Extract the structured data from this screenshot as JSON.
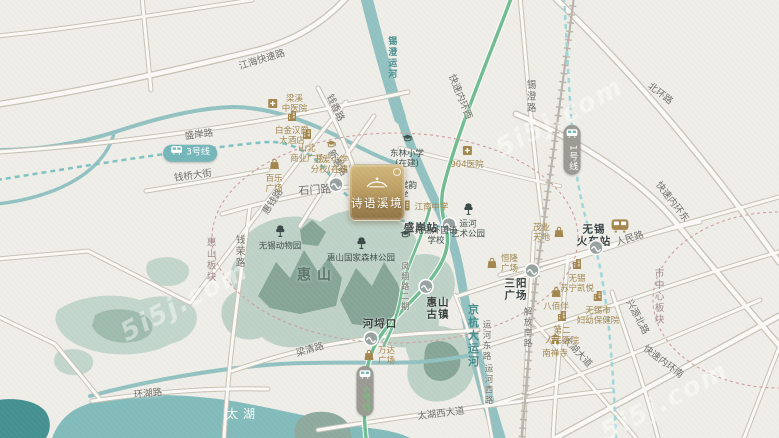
{
  "property": {
    "name": "诗语溪境"
  },
  "watermark_text": "5i5j.com",
  "labels": [
    {
      "n": "road-label-jianghai-expressway",
      "t": "road",
      "x": 262,
      "y": 60,
      "r": -17,
      "lines": [
        "江海快速路"
      ]
    },
    {
      "n": "road-label-shengan-road",
      "t": "road",
      "x": 199,
      "y": 135,
      "r": -7,
      "lines": [
        "盛岸路"
      ]
    },
    {
      "n": "road-label-qianqiao-street",
      "t": "road",
      "x": 193,
      "y": 176,
      "r": -8,
      "lines": [
        "钱桥大街"
      ]
    },
    {
      "n": "road-label-huiqian-road",
      "t": "road",
      "x": 273,
      "y": 202,
      "r": -56,
      "lines": [
        "惠钱路"
      ]
    },
    {
      "n": "road-label-qianxiang-road",
      "t": "road",
      "x": 335,
      "y": 108,
      "r": 64,
      "lines": [
        "钱香路"
      ]
    },
    {
      "n": "road-label-xinhui-road",
      "t": "road",
      "x": 337,
      "y": 163,
      "r": 60,
      "lines": [
        "新惠路"
      ]
    },
    {
      "n": "road-label-shimen-road",
      "t": "road",
      "x": 315,
      "y": 191,
      "r": -4,
      "fs": 11,
      "lines": [
        "石门路"
      ]
    },
    {
      "n": "road-label-inner-ring-west",
      "t": "road",
      "x": 460,
      "y": 97,
      "r": 68,
      "lines": [
        "快速内环西"
      ]
    },
    {
      "n": "road-label-xicheng-road",
      "t": "road",
      "x": 530,
      "y": 97,
      "v": 1,
      "lines": [
        "锡澄路"
      ]
    },
    {
      "n": "road-label-beihuan-road",
      "t": "road",
      "x": 660,
      "y": 94,
      "r": 38,
      "lines": [
        "北环路"
      ]
    },
    {
      "n": "road-label-inner-ring-east",
      "t": "road",
      "x": 672,
      "y": 202,
      "r": 52,
      "lines": [
        "快速内环东"
      ]
    },
    {
      "n": "road-label-renmin-road",
      "t": "road",
      "x": 630,
      "y": 239,
      "r": -17,
      "lines": [
        "人民路"
      ]
    },
    {
      "n": "road-label-xingyuan-north-road",
      "t": "road",
      "x": 637,
      "y": 317,
      "r": 62,
      "lines": [
        "兴源北路"
      ]
    },
    {
      "n": "road-label-taihu-avenue",
      "t": "road",
      "x": 577,
      "y": 352,
      "r": 47,
      "lines": [
        "太湖大道"
      ]
    },
    {
      "n": "road-label-inner-ring-south",
      "t": "road",
      "x": 663,
      "y": 362,
      "r": 37,
      "lines": [
        "快速内环南"
      ]
    },
    {
      "n": "road-label-liangqing-road",
      "t": "road",
      "x": 310,
      "y": 350,
      "r": -16,
      "lines": [
        "梁清路"
      ]
    },
    {
      "n": "road-label-huanhu-road",
      "t": "road",
      "x": 148,
      "y": 394,
      "r": -6,
      "lines": [
        "环湖路"
      ]
    },
    {
      "n": "road-label-taihu-west-avenue",
      "t": "road",
      "x": 441,
      "y": 414,
      "r": -7,
      "lines": [
        "太湖西大道"
      ]
    },
    {
      "n": "road-label-yunhe-east-road",
      "t": "road",
      "x": 486,
      "y": 341,
      "v": 1,
      "fs": 8.5,
      "lines": [
        "运河东路"
      ]
    },
    {
      "n": "road-label-yunhe-west-road",
      "t": "road",
      "x": 488,
      "y": 385,
      "v": 1,
      "fs": 8.5,
      "lines": [
        "运河西路"
      ]
    },
    {
      "n": "road-label-qianrong-road",
      "t": "road",
      "x": 239,
      "y": 252,
      "v": 1,
      "lines": [
        "钱荣路"
      ]
    },
    {
      "n": "road-label-jiefang-south-road",
      "t": "road",
      "x": 527,
      "y": 328,
      "v": 1,
      "fs": 8.5,
      "lines": [
        "解放南路"
      ]
    },
    {
      "n": "road-label-fengxiang-road-phase2",
      "t": "road",
      "x": 405,
      "y": 287,
      "v": 1,
      "fs": 8,
      "lines": [
        "凤翔路二期"
      ]
    },
    {
      "n": "river-label-xicheng-canal",
      "t": "river",
      "x": 391,
      "y": 58,
      "v": 1,
      "fs": 9,
      "lines": [
        "锡澄运河"
      ]
    },
    {
      "n": "river-label-jinghang-grand-canal",
      "t": "river",
      "x": 472,
      "y": 336,
      "v": 1,
      "fs": 11,
      "lines": [
        "京杭大运河"
      ]
    },
    {
      "n": "area-label-huishan-mountain",
      "t": "area",
      "x": 317,
      "y": 276,
      "lines": [
        "惠山"
      ]
    },
    {
      "n": "lake-label-taihu",
      "t": "lake",
      "x": 243,
      "y": 414,
      "lines": [
        "太湖"
      ]
    },
    {
      "n": "region-label-huishan-block",
      "t": "region",
      "x": 210,
      "y": 260,
      "v": 1,
      "lines": [
        "惠山板块"
      ]
    },
    {
      "n": "region-label-city-center-block",
      "t": "region",
      "x": 658,
      "y": 297,
      "v": 1,
      "lines": [
        "市中心板块"
      ]
    },
    {
      "n": "metro-line3-badge",
      "t": "metro-h",
      "x": 190,
      "y": 153,
      "ic": "train-icon",
      "lines": [
        "3号线"
      ]
    },
    {
      "n": "metro-line1-badge",
      "t": "metro-v",
      "x": 572,
      "y": 150,
      "ic": "train-icon",
      "lines": [
        "1号线"
      ]
    },
    {
      "n": "metro-line4-badge",
      "t": "metro-v4",
      "x": 365,
      "y": 391,
      "ic": "train-icon",
      "lines": [
        "4号线"
      ]
    },
    {
      "n": "station-icon-shimen-road",
      "t": "sta-dot",
      "x": 336,
      "y": 187
    },
    {
      "n": "station-label-shengan",
      "t": "sta",
      "x": 421,
      "y": 228,
      "lines": [
        "盛岸站"
      ]
    },
    {
      "n": "station-icon-shengan",
      "t": "sta-dot",
      "x": 449,
      "y": 227
    },
    {
      "n": "station-label-heleikou",
      "t": "sta",
      "x": 380,
      "y": 324,
      "lines": [
        "河埒口"
      ]
    },
    {
      "n": "station-icon-heleikou",
      "t": "sta-dot",
      "x": 371,
      "y": 341
    },
    {
      "n": "station-icon-huishan-old-town",
      "t": "sta-dot",
      "x": 426,
      "y": 289
    },
    {
      "n": "station-label-huishan-old-town",
      "t": "sta",
      "x": 438,
      "y": 309,
      "lines": [
        "惠山",
        "古镇"
      ]
    },
    {
      "n": "station-icon-sanyang-plaza",
      "t": "sta-dot",
      "x": 532,
      "y": 273
    },
    {
      "n": "station-label-sanyang-plaza",
      "t": "sta",
      "x": 516,
      "y": 290,
      "lines": [
        "三阳",
        "广场"
      ]
    },
    {
      "n": "station-label-wuxi-railway-station",
      "t": "sta",
      "x": 594,
      "y": 236,
      "lines": [
        "无锡",
        "火车站"
      ]
    },
    {
      "n": "poi-wuxi-railway-station-train",
      "t": "gold",
      "x": 620,
      "y": 228,
      "ic": "train-icon-gold",
      "fs": 9,
      "lines": []
    },
    {
      "n": "station-icon-wuxi-railway-station",
      "t": "sta-dot",
      "x": 596,
      "y": 250
    },
    {
      "n": "poi-liangxi-tcm-hospital",
      "t": "gold",
      "x": 287,
      "y": 104,
      "ic": "hospital-icon",
      "side": "right",
      "lines": [
        "梁溪",
        "中医院"
      ]
    },
    {
      "n": "poi-baijinhanjue-hotel",
      "t": "gold",
      "x": 292,
      "y": 128,
      "ic": "building-icon",
      "lines": [
        "白金汉爵",
        "大酒店"
      ]
    },
    {
      "n": "poi-shanbei-commercial-plaza",
      "t": "gold",
      "x": 307,
      "y": 146,
      "ic": "building-icon",
      "lines": [
        "山北",
        "商业广场"
      ]
    },
    {
      "n": "poi-baile-plaza",
      "t": "gold",
      "x": 274,
      "y": 176,
      "ic": "bag-icon",
      "lines": [
        "百乐",
        "广场"
      ]
    },
    {
      "n": "poi-wuai-primary-school-branch",
      "t": "gold",
      "x": 331,
      "y": 157,
      "ic": "school-icon-gold",
      "lines": [
        "五爱小学",
        "分校(在建)"
      ]
    },
    {
      "n": "poi-904-hospital",
      "t": "gold",
      "x": 467,
      "y": 157,
      "ic": "hospital-icon",
      "lines": [
        "904医院"
      ]
    },
    {
      "n": "poi-jiangnan-middle-school",
      "t": "gold",
      "x": 424,
      "y": 207,
      "ic": "building-icon",
      "side": "right",
      "lines": [
        "江南中学"
      ]
    },
    {
      "n": "poi-wanda-plaza",
      "t": "gold",
      "x": 379,
      "y": 356,
      "ic": "bag-icon",
      "side": "right",
      "lines": [
        "万达",
        "广场"
      ]
    },
    {
      "n": "poi-henglong-plaza",
      "t": "gold",
      "x": 502,
      "y": 264,
      "ic": "bag-icon",
      "side": "right",
      "lines": [
        "恒隆",
        "广场"
      ]
    },
    {
      "n": "poi-maoye-tiandi",
      "t": "gold",
      "x": 549,
      "y": 233,
      "ic": "bag-icon",
      "side": "left",
      "lines": [
        "茂业",
        "天地"
      ]
    },
    {
      "n": "poi-suning-kaiyue-hotel",
      "t": "gold",
      "x": 577,
      "y": 276,
      "ic": "building-icon",
      "lines": [
        "无锡",
        "苏宁凯悦"
      ]
    },
    {
      "n": "poi-yaohan",
      "t": "gold",
      "x": 556,
      "y": 299,
      "ic": "bag-icon",
      "lines": [
        "八佰伴"
      ]
    },
    {
      "n": "poi-wuxi-maternity-hospital",
      "t": "gold",
      "x": 598,
      "y": 308,
      "ic": "building-icon",
      "lines": [
        "无锡市",
        "妇幼保健院"
      ]
    },
    {
      "n": "poi-second-peoples-hospital",
      "t": "gold",
      "x": 562,
      "y": 328,
      "ic": "building-icon",
      "lines": [
        "第二",
        "人民医院"
      ]
    },
    {
      "n": "poi-nanchan-temple",
      "t": "gold",
      "x": 555,
      "y": 346,
      "ic": "temple-icon",
      "lines": [
        "南禅寺"
      ]
    },
    {
      "n": "poi-wuxi-zoo",
      "t": "dark",
      "x": 280,
      "y": 238,
      "ic": "tree-icon",
      "lines": [
        "无锡动物园"
      ]
    },
    {
      "n": "poi-huishan-national-forest-park",
      "t": "dark",
      "x": 361,
      "y": 250,
      "ic": "tree-icon",
      "lines": [
        "惠山国家森林公园"
      ]
    },
    {
      "n": "poi-donglin-primary-school",
      "t": "dark",
      "x": 407,
      "y": 151,
      "ic": "school-icon",
      "lines": [
        "东林小学",
        "(在建)"
      ]
    },
    {
      "n": "poi-lianyuan-primary-school",
      "t": "dark",
      "x": 400,
      "y": 191,
      "lines": [
        "连元棠韵",
        "小学"
      ]
    },
    {
      "n": "poi-wuxi-foreign-language-school",
      "t": "dark",
      "x": 428,
      "y": 236,
      "ic": "school-icon",
      "side": "right",
      "lines": [
        "无锡外国语",
        "学校"
      ]
    },
    {
      "n": "poi-canal-art-park",
      "t": "dark",
      "x": 468,
      "y": 221,
      "ic": "tree-icon",
      "lines": [
        "运河",
        "艺术公园"
      ]
    },
    {
      "n": "watermark",
      "t": "wm",
      "x": 185,
      "y": 302,
      "r": -28,
      "lines": [
        "5i5j.com"
      ]
    },
    {
      "n": "watermark",
      "t": "wm",
      "x": 560,
      "y": 118,
      "r": -28,
      "lines": [
        "5i5j.com"
      ]
    },
    {
      "n": "watermark",
      "t": "wm",
      "x": 665,
      "y": 402,
      "r": -28,
      "lines": [
        "5i5j.com"
      ]
    }
  ]
}
